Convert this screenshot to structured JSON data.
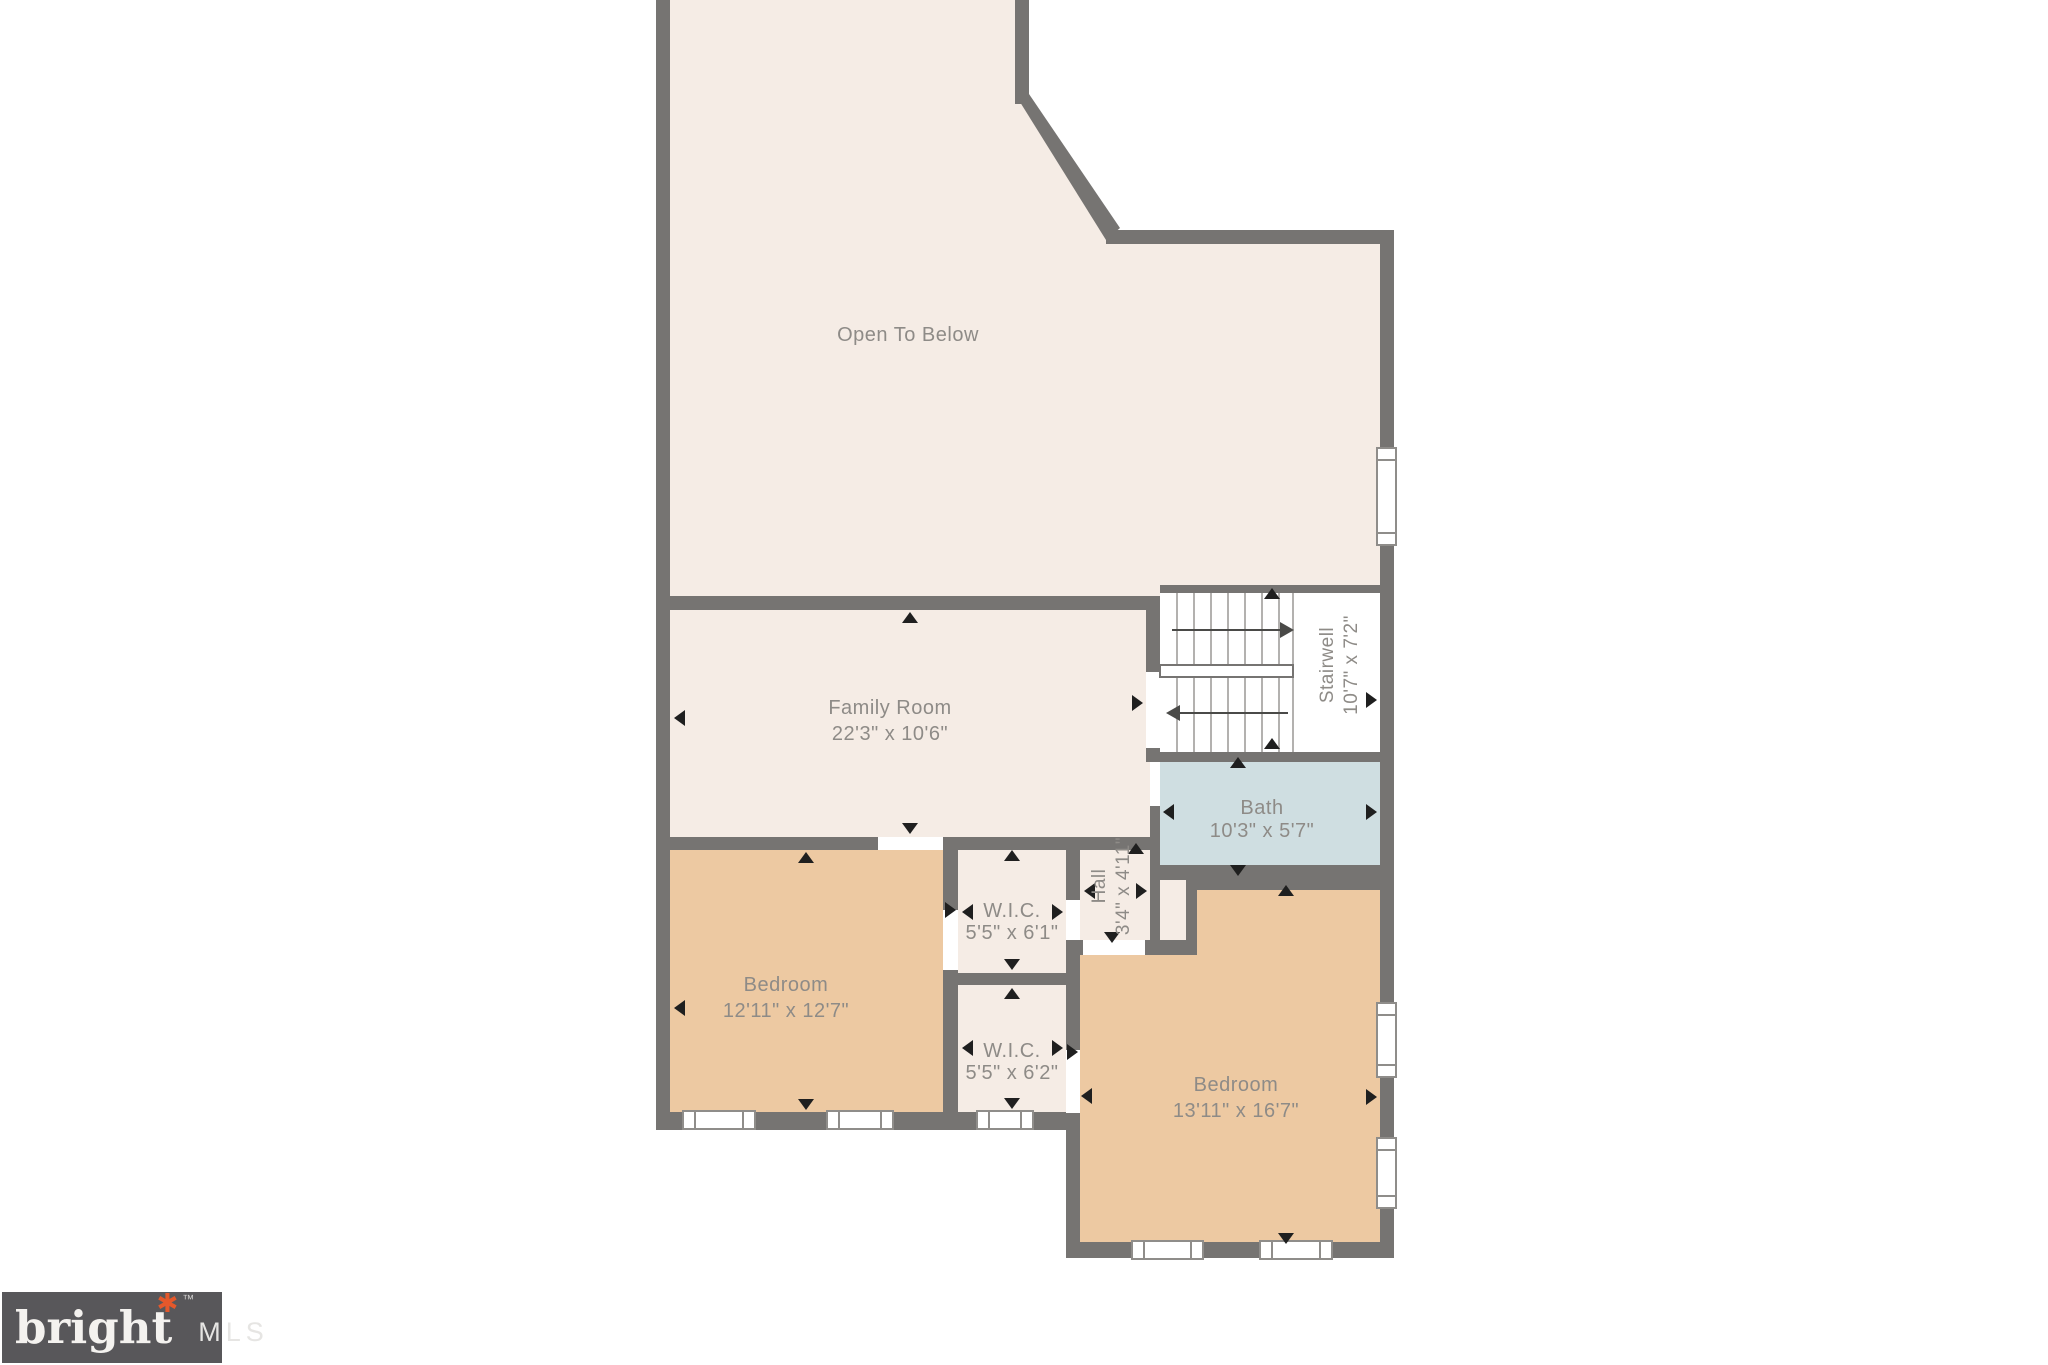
{
  "plan": {
    "rooms": {
      "open_below": {
        "name": "Open To Below",
        "dims": ""
      },
      "family": {
        "name": "Family Room",
        "dims": "22'3\" x 10'6\""
      },
      "stairwell": {
        "name": "Stairwell",
        "dims": "10'7\" x 7'2\""
      },
      "bath": {
        "name": "Bath",
        "dims": "10'3\" x 5'7\""
      },
      "wic1": {
        "name": "W.I.C.",
        "dims": "5'5\" x 6'1\""
      },
      "wic2": {
        "name": "W.I.C.",
        "dims": "5'5\" x 6'2\""
      },
      "hall": {
        "name": "Hall",
        "dims": "3'4\" x 4'11\""
      },
      "bedroom1": {
        "name": "Bedroom",
        "dims": "12'11\" x 12'7\""
      },
      "bedroom2": {
        "name": "Bedroom",
        "dims": "13'11\" x 16'7\""
      }
    },
    "colors": {
      "wall": "#767472",
      "room_cream": "#f5ece5",
      "room_tan": "#edc9a2",
      "room_bath_blue": "#cfdee1",
      "stair_white": "#ffffff",
      "label_text": "#8e8b87",
      "marker_black": "#1f1f1f"
    }
  },
  "logo": {
    "brand": "bright",
    "suffix": "MLS",
    "trademark": "™",
    "star": "✱",
    "background": "#58575a",
    "star_color": "#e4582b"
  }
}
